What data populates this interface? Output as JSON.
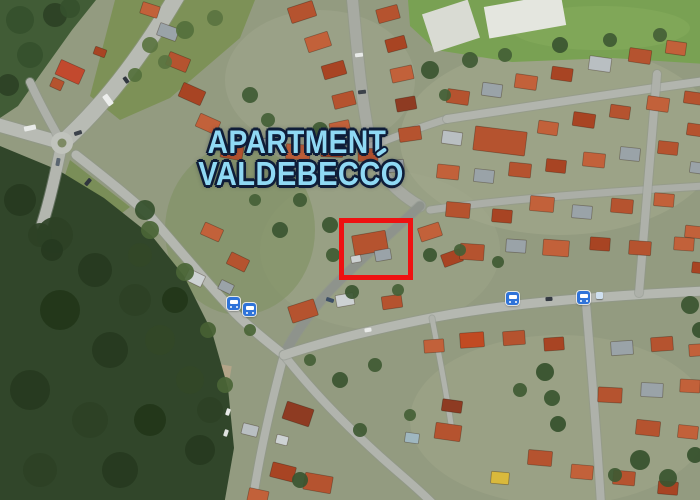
{
  "title": {
    "line1": "APARTMENT",
    "line2": "VALDEBECCO"
  },
  "colors": {
    "title_fill": "#8fd9f4",
    "title_outline": "#0f1d38",
    "highlight_red": "#ee1111",
    "bus_blue": "#2f73d9"
  },
  "markers": {
    "bus_stop_count": 4,
    "highlighted_building": "building inside red rectangle"
  }
}
